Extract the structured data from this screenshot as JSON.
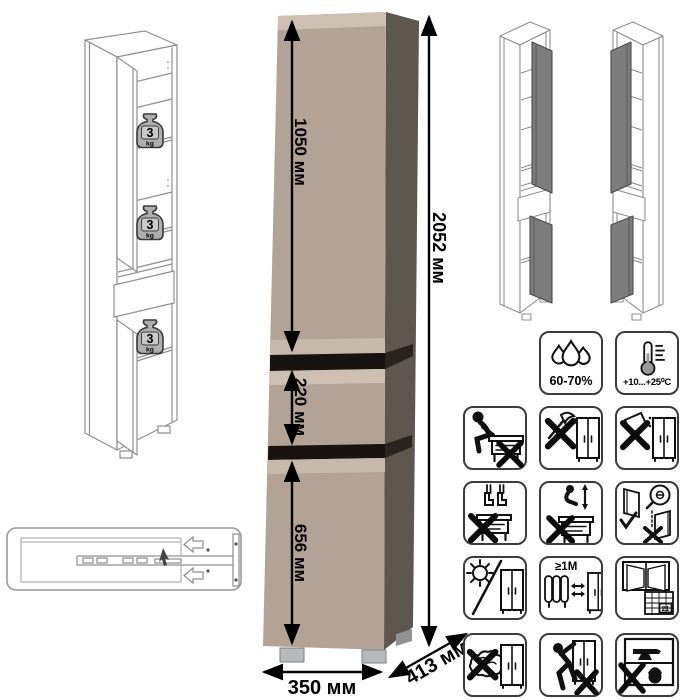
{
  "product_render": {
    "dimensions": {
      "total_height": "2052 мм",
      "upper_door_height": "1050 мм",
      "drawer_height": "220 мм",
      "lower_door_height": "656 мм",
      "width": "350 мм",
      "depth": "413 мм"
    },
    "colors": {
      "front": "#b2a396",
      "front_bevel": "#cdbfb2",
      "side": "#5e574f",
      "section_gap": "#181310",
      "foot": "#b6b9bc",
      "open_door_grey": "#7d7d7d"
    }
  },
  "wireframes": {
    "shelf_load": {
      "value": "3",
      "unit": "kg"
    }
  },
  "care_icons": {
    "humidity": {
      "name": "humidity-drops-icon",
      "label": "60-70%"
    },
    "temperature": {
      "name": "thermometer-icon",
      "label": "+10...+25⁰C"
    },
    "no_sitting": {
      "name": "no-sitting-icon"
    },
    "no_sharp_tools": {
      "name": "no-sharp-tools-icon"
    },
    "no_spilling": {
      "name": "no-spilling-icon"
    },
    "no_standing": {
      "name": "no-standing-icon"
    },
    "no_jumping": {
      "name": "no-jumping-icon"
    },
    "door_adjustment": {
      "name": "door-adjustment-icon"
    },
    "no_direct_sunlight": {
      "name": "no-sunlight-icon"
    },
    "heat_distance": {
      "name": "heat-distance-icon",
      "label": "≥1М"
    },
    "ventilation": {
      "name": "ventilation-calendar-icon",
      "calendar_day": "21"
    },
    "no_wet_cloth": {
      "name": "no-wet-cloth-icon"
    },
    "no_dragging": {
      "name": "no-dragging-icon"
    },
    "no_overload": {
      "name": "no-overload-icon"
    }
  }
}
